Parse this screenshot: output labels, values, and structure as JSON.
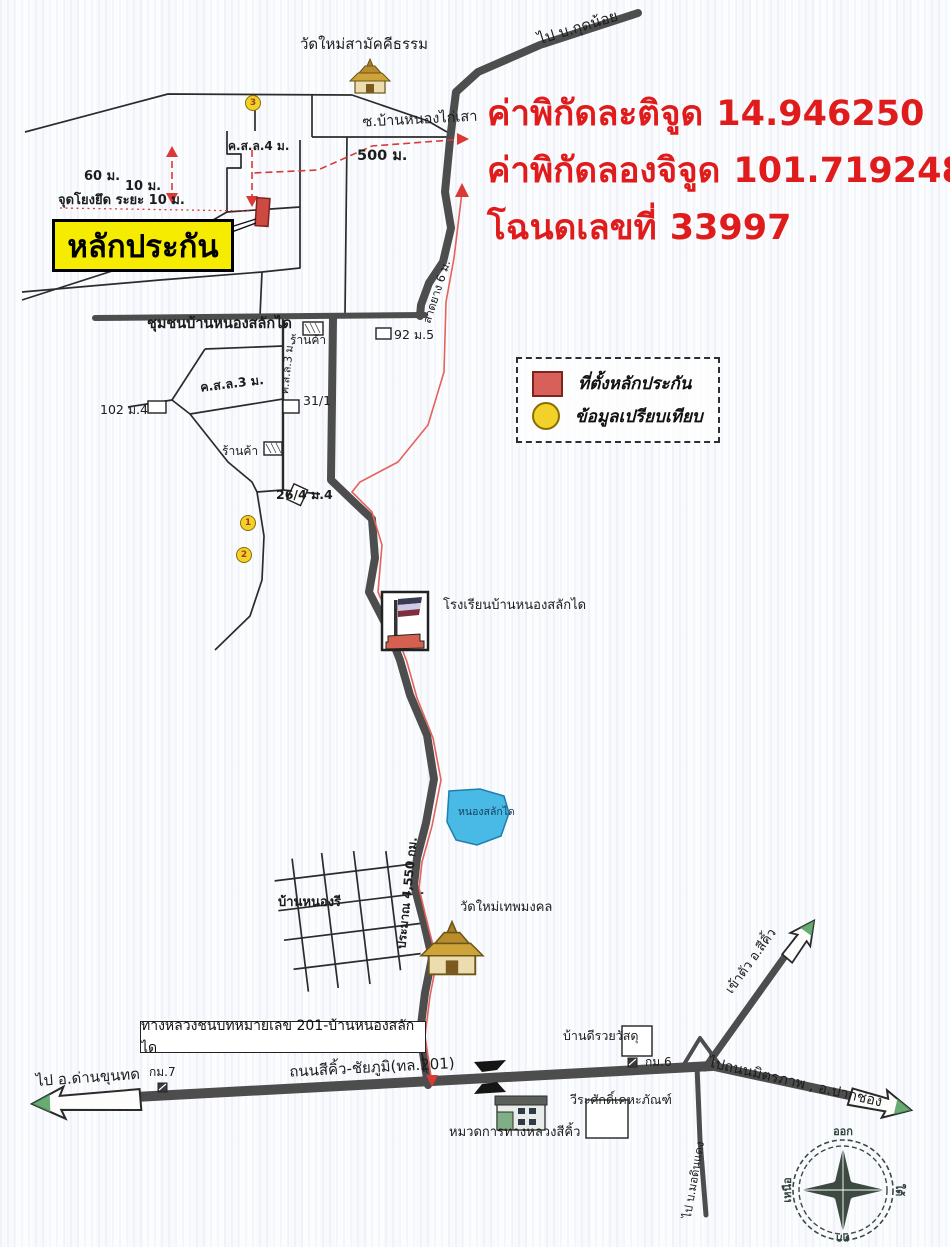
{
  "coordinates": {
    "latitude_label": "ค่าพิกัดละติจูด",
    "latitude_value": "14.946250",
    "longitude_label": "ค่าพิกัดลองจิจูด",
    "longitude_value": "101.719248",
    "deed_label": "โฉนดเลขที่",
    "deed_value": "33997"
  },
  "collateral": {
    "label": "หลักประกัน",
    "anchor_note": "จุดโยงยึด ระยะ 10 ม."
  },
  "legend": {
    "items": [
      {
        "symbol": "red-square",
        "label": "ที่ตั้งหลักประกัน"
      },
      {
        "symbol": "yellow-circle",
        "label": "ข้อมูลเปรียบเทียบ"
      }
    ]
  },
  "measurements": {
    "d500": "500 ม.",
    "d60": "60 ม.",
    "d10": "10 ม."
  },
  "comparison_points": {
    "p1": "1",
    "p2": "2",
    "p3": "3"
  },
  "labels": {
    "temple_north": "วัดใหม่สามัคคีธรรม",
    "to_ban_kut_noi": "ไป บ.กุดน้อย",
    "soi_ban_nong_kai_sao": "ซ.บ้านหนองไก่เสา",
    "road_csl_4m": "ค.ส.ล.4 ม.",
    "community": "ชุมชนบ้านหนองสลักได",
    "shop_north": "ร้านค้า",
    "house_92_m5": "92 ม.5",
    "road_latyang_6m": "ลาดยาง 6 ม.",
    "road_csl_3m": "ค.ส.ล.3 ม.",
    "road_csl_3m_vertical": "ค.ส.ล.3 ม.",
    "house_31_1": "31/1",
    "house_102_m4": "102 ม.4",
    "shop_south": "ร้านค้า",
    "house_26_4_m4": "26/4 ม.4",
    "school": "โรงเรียนบ้านหนองสลักได",
    "pond": "หนองสลักได",
    "distance_along_road": "ประมาณ 4,550 กม.",
    "village_ban_nong_ri": "บ้านหนองรี",
    "temple_south": "วัดใหม่เทพมงคล",
    "to_sikhio_town": "เข้าตัว อ.สีคิ้ว",
    "callout_rural_highway": "ทางหลวงชนบทหมายเลข 201-บ้านหนองสลักได",
    "shop_bandee": "บ้านดีรวยวัสดุ",
    "km6": "กม.6",
    "to_mittraphap_pakchong": "ไปถนนมิตรภาพ , อ.ปากช่อง",
    "to_dan_khun_thot": "ไป อ.ด่านขุนทด",
    "km7": "กม.7",
    "highway_sikhio_chaiyaphum": "ถนนสีคิ้ว-ชัยภูมิ(ทล.201)",
    "weerasak_kehaphan": "วีระศักดิ์เคหะภัณฑ์",
    "highway_maintenance": "หมวดการทางหลวงสีคิ้ว",
    "to_ban_mo_din_daeng": "ไป บ.มอดินแดง"
  },
  "compass": {
    "top": "ออก",
    "right": "ใต้",
    "bottom": "ตก",
    "left": "เหนือ"
  },
  "colors": {
    "highlight_red": "#e01b1b",
    "collateral_yellow": "#f6ec00",
    "road_dark": "#4d4d4d",
    "pond_blue": "#49b9e6",
    "marker_red": "#cc4a42",
    "compare_yellow": "#f2d12b",
    "route_red": "#e4625a"
  }
}
